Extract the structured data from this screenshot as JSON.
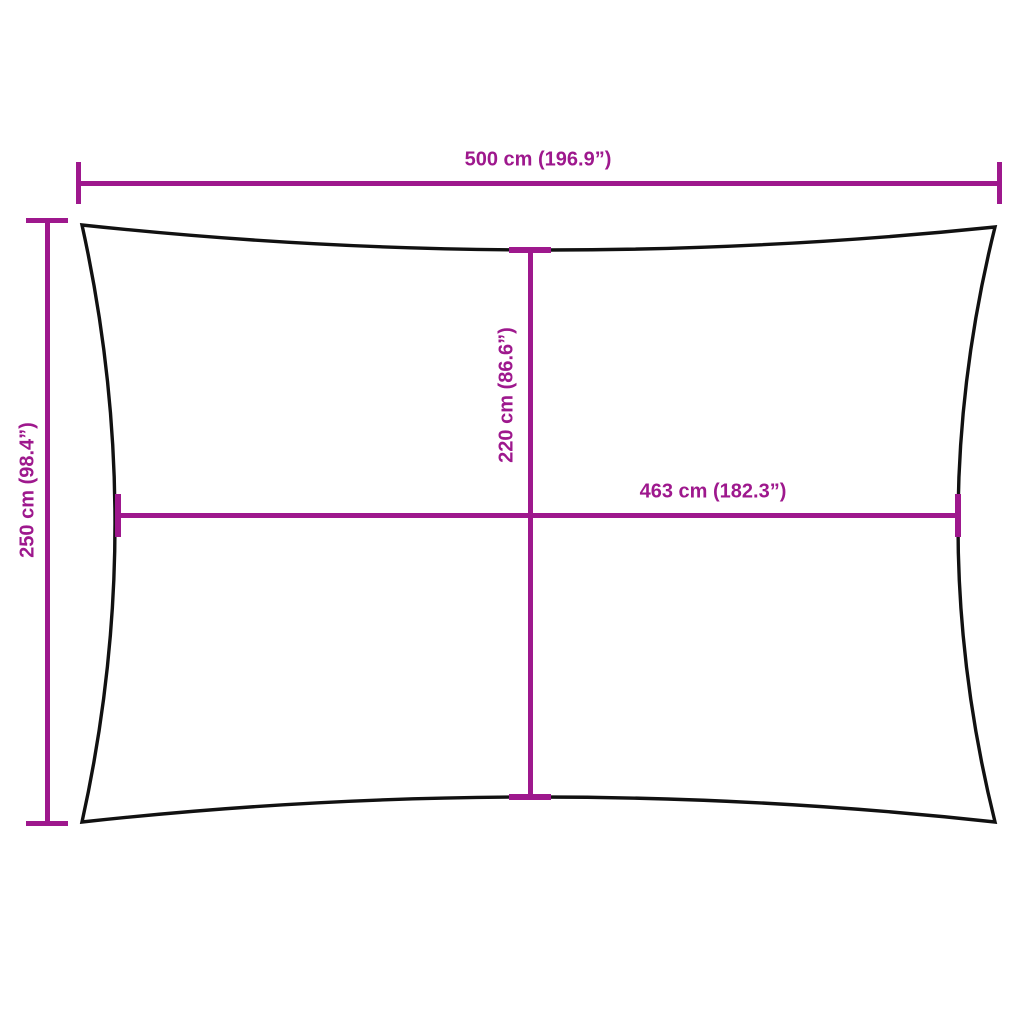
{
  "page": {
    "background": "#ffffff"
  },
  "colors": {
    "accent": "#9E188D",
    "outline": "#111111"
  },
  "diagram": {
    "type": "product-dimension-diagram",
    "shape": "rectangle-with-concave-edges",
    "labels": {
      "width_top": "500 cm (196.9”)",
      "height_left": "250 cm (98.4”)",
      "inner_height": "220 cm (86.6”)",
      "inner_width": "463 cm (182.3”)"
    }
  }
}
